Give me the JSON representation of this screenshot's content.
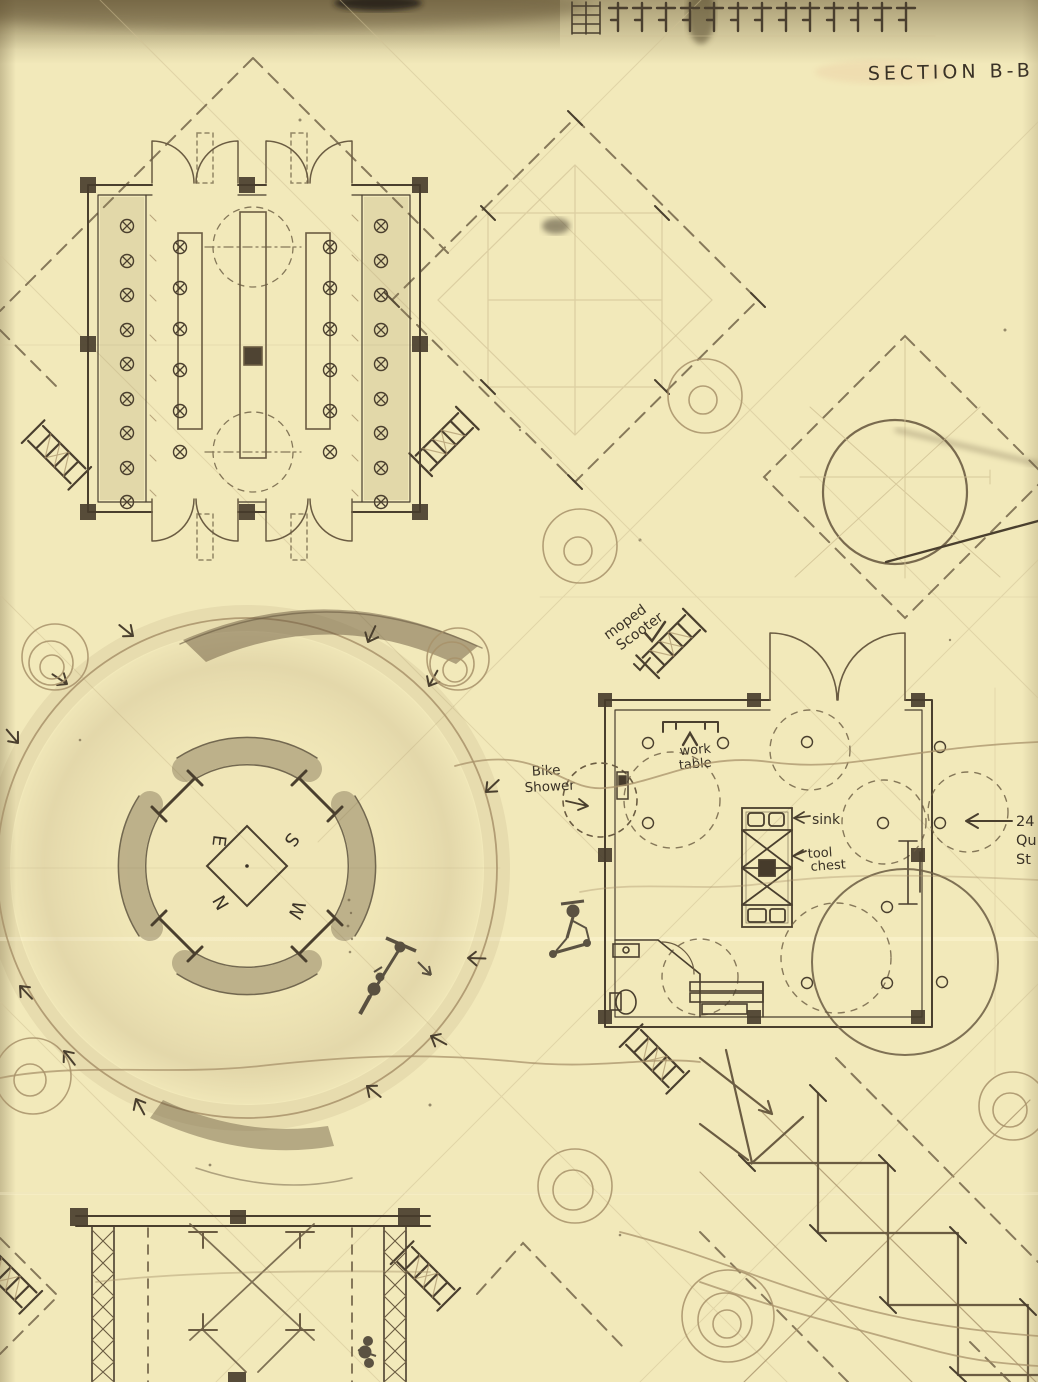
{
  "sheet": {
    "drawing_label": "SECTION B-B",
    "palette": {
      "paper": "#f2e9ba",
      "graphite_dark": "#3a3226",
      "graphite_mid": "#6b5c42",
      "sepia_light": "#b49a6e"
    }
  },
  "annotations": {
    "section_label": "SECTION B-B",
    "moped": {
      "line1": "moped",
      "line2": "Scooter"
    },
    "work_table": {
      "line1": "work",
      "line2": "table"
    },
    "bike_shower": {
      "line1": "Bike",
      "line2": "Shower"
    },
    "sink": "sink",
    "tool_chest": {
      "line1": "tool",
      "line2": "chest"
    },
    "right_edge_label": {
      "line1": "24",
      "line2": "Qu",
      "line3": "St"
    }
  },
  "compass": {
    "east": "E",
    "south": "S",
    "north": "N",
    "west": "W"
  }
}
